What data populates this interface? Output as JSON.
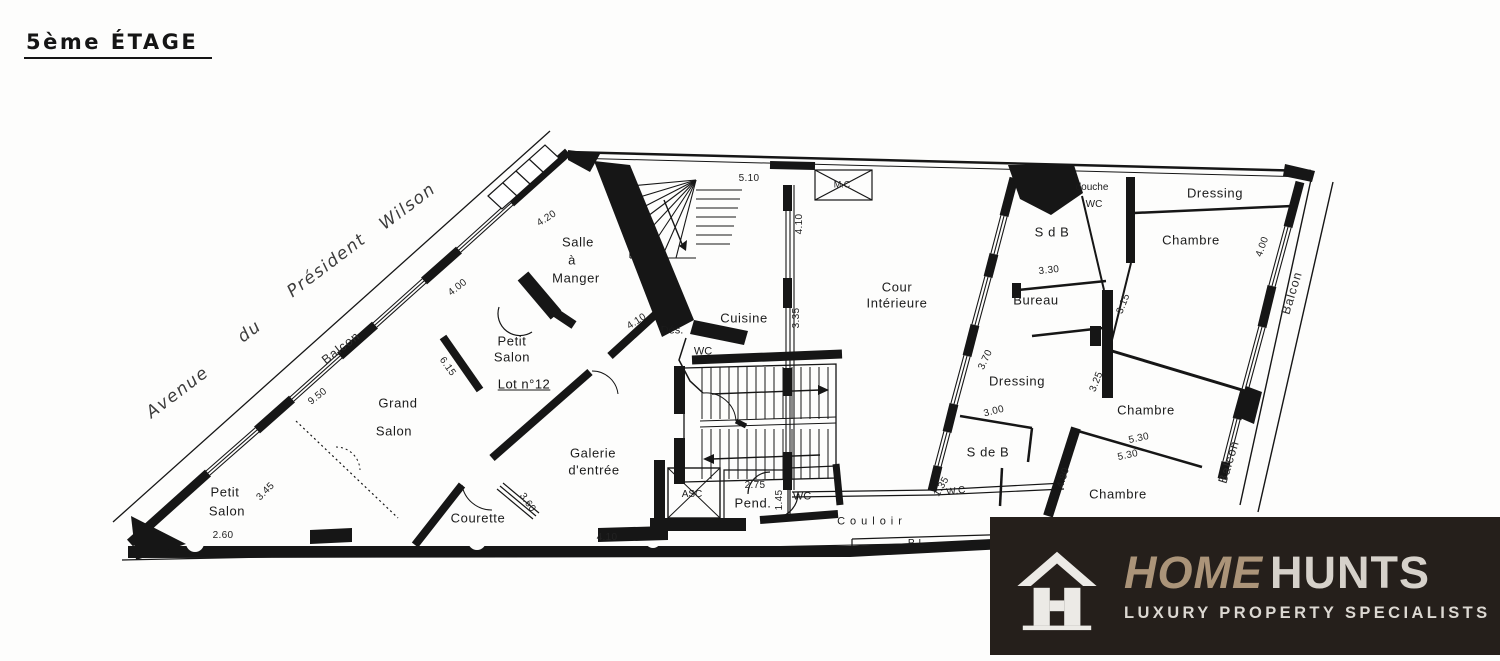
{
  "page": {
    "title": "5ème ÉTAGE"
  },
  "plan": {
    "labels": [
      {
        "text": "Avenue",
        "x": 178,
        "y": 393,
        "rot": -37,
        "cls": "street",
        "name": "street-label-avenue"
      },
      {
        "text": "du",
        "x": 250,
        "y": 332,
        "rot": -37,
        "cls": "street",
        "name": "street-label-du"
      },
      {
        "text": "Président",
        "x": 327,
        "y": 266,
        "rot": -37,
        "cls": "street",
        "name": "street-label-president"
      },
      {
        "text": "Wilson",
        "x": 408,
        "y": 207,
        "rot": -37,
        "cls": "street",
        "name": "street-label-wilson"
      },
      {
        "text": "Balcon",
        "x": 341,
        "y": 348,
        "rot": -38,
        "cls": "balcony",
        "name": "balcony-label-facade"
      },
      {
        "text": "Balcon",
        "x": 1292,
        "y": 293,
        "rot": -73,
        "cls": "balcony",
        "name": "balcony-label-right-upper"
      },
      {
        "text": "Balcon",
        "x": 1229,
        "y": 462,
        "rot": -73,
        "cls": "balcony",
        "name": "balcony-label-right-lower"
      },
      {
        "text": "Salle",
        "x": 578,
        "y": 242,
        "cls": "room",
        "name": "room-label-salle-a-manger"
      },
      {
        "text": "à",
        "x": 572,
        "y": 260,
        "cls": "room",
        "name": "room-label-salle-a-manger"
      },
      {
        "text": "Manger",
        "x": 576,
        "y": 278,
        "cls": "room",
        "name": "room-label-salle-a-manger"
      },
      {
        "text": "Petit",
        "x": 512,
        "y": 341,
        "cls": "room",
        "name": "room-label-petit-salon-1"
      },
      {
        "text": "Salon",
        "x": 512,
        "y": 357,
        "cls": "room",
        "name": "room-label-petit-salon-1"
      },
      {
        "text": "Lot n°12",
        "x": 524,
        "y": 384,
        "cls": "lot",
        "name": "area-label-lot-12"
      },
      {
        "text": "Grand",
        "x": 398,
        "y": 403,
        "cls": "room",
        "name": "room-label-grand-salon"
      },
      {
        "text": "Salon",
        "x": 394,
        "y": 431,
        "cls": "room",
        "name": "room-label-grand-salon"
      },
      {
        "text": "Petit",
        "x": 225,
        "y": 492,
        "cls": "room",
        "name": "room-label-petit-salon-2"
      },
      {
        "text": "Salon",
        "x": 227,
        "y": 511,
        "cls": "room",
        "name": "room-label-petit-salon-2"
      },
      {
        "text": "Galerie",
        "x": 593,
        "y": 453,
        "cls": "room",
        "name": "room-label-galerie"
      },
      {
        "text": "d'entrée",
        "x": 594,
        "y": 470,
        "cls": "room",
        "name": "room-label-galerie"
      },
      {
        "text": "Courette",
        "x": 478,
        "y": 518,
        "cls": "room",
        "name": "room-label-courette"
      },
      {
        "text": "Cuisine",
        "x": 744,
        "y": 318,
        "cls": "room",
        "name": "room-label-cuisine"
      },
      {
        "text": "Cour",
        "x": 897,
        "y": 287,
        "cls": "room",
        "name": "room-label-cour-interieure"
      },
      {
        "text": "Intérieure",
        "x": 897,
        "y": 303,
        "cls": "room",
        "name": "room-label-cour-interieure"
      },
      {
        "text": "S d B",
        "x": 1052,
        "y": 232,
        "cls": "room",
        "name": "room-label-sdb"
      },
      {
        "text": "Bureau",
        "x": 1036,
        "y": 300,
        "cls": "room",
        "name": "room-label-bureau"
      },
      {
        "text": "Dressing",
        "x": 1017,
        "y": 381,
        "cls": "room",
        "name": "room-label-dressing-mid"
      },
      {
        "text": "Dressing",
        "x": 1215,
        "y": 193,
        "cls": "room",
        "name": "room-label-dressing-top"
      },
      {
        "text": "Chambre",
        "x": 1191,
        "y": 240,
        "cls": "room",
        "name": "room-label-chambre-1"
      },
      {
        "text": "Chambre",
        "x": 1146,
        "y": 410,
        "cls": "room",
        "name": "room-label-chambre-2"
      },
      {
        "text": "Chambre",
        "x": 1118,
        "y": 494,
        "cls": "room",
        "name": "room-label-chambre-3"
      },
      {
        "text": "S de B",
        "x": 988,
        "y": 452,
        "cls": "room",
        "name": "room-label-s-de-b"
      },
      {
        "text": "Pend.",
        "x": 753,
        "y": 503,
        "cls": "room",
        "name": "room-label-penderie"
      },
      {
        "text": "Couloir",
        "x": 872,
        "y": 522,
        "ls": 5,
        "cls": "small",
        "name": "room-label-couloir"
      },
      {
        "text": "PL",
        "x": 918,
        "y": 544,
        "ls": 4,
        "size": 10,
        "cls": "small",
        "name": "room-label-placard"
      },
      {
        "text": "WC",
        "x": 703,
        "y": 352,
        "cls": "small",
        "name": "room-label-wc-cuisine"
      },
      {
        "text": "Dés.",
        "x": 672,
        "y": 331,
        "cls": "small",
        "name": "room-label-degagement"
      },
      {
        "text": "M.C",
        "x": 842,
        "y": 185,
        "size": 9,
        "cls": "small",
        "name": "room-label-monte-charge"
      },
      {
        "text": "douche",
        "x": 1092,
        "y": 188,
        "size": 10,
        "cls": "small",
        "name": "room-label-douche"
      },
      {
        "text": "WC",
        "x": 1094,
        "y": 205,
        "size": 10,
        "cls": "small",
        "name": "room-label-wc-douche"
      },
      {
        "text": "W.C",
        "x": 956,
        "y": 492,
        "rot": -8,
        "size": 10,
        "cls": "small",
        "name": "room-label-wc-couloir"
      },
      {
        "text": "ASC",
        "x": 692,
        "y": 495,
        "size": 10,
        "cls": "small",
        "name": "room-label-ascenseur"
      },
      {
        "text": "WC",
        "x": 802,
        "y": 497,
        "cls": "small",
        "name": "room-label-wc-hall"
      },
      {
        "text": "4.20",
        "x": 547,
        "y": 219,
        "rot": -33,
        "cls": "dim",
        "name": "dimension-label"
      },
      {
        "text": "5.10",
        "x": 749,
        "y": 179,
        "cls": "dim",
        "name": "dimension-label"
      },
      {
        "text": "4.10",
        "x": 800,
        "y": 224,
        "rot": -90,
        "cls": "dim",
        "name": "dimension-label"
      },
      {
        "text": "3.35",
        "x": 797,
        "y": 318,
        "rot": -90,
        "cls": "dim",
        "name": "dimension-label"
      },
      {
        "text": "4.10",
        "x": 637,
        "y": 322,
        "rot": -33,
        "cls": "dim",
        "name": "dimension-label"
      },
      {
        "text": "6.15",
        "x": 447,
        "y": 367,
        "rot": 55,
        "cls": "dim",
        "name": "dimension-label"
      },
      {
        "text": "9.50",
        "x": 318,
        "y": 397,
        "rot": -38,
        "cls": "dim",
        "name": "dimension-label"
      },
      {
        "text": "4.00",
        "x": 458,
        "y": 288,
        "rot": -38,
        "cls": "dim",
        "name": "dimension-label"
      },
      {
        "text": "3.45",
        "x": 266,
        "y": 492,
        "rot": -45,
        "cls": "dim",
        "name": "dimension-label"
      },
      {
        "text": "2.60",
        "x": 223,
        "y": 536,
        "cls": "dim",
        "name": "dimension-label"
      },
      {
        "text": "3.60",
        "x": 527,
        "y": 503,
        "rot": 55,
        "cls": "dim",
        "name": "dimension-label"
      },
      {
        "text": "4.10",
        "x": 607,
        "y": 538,
        "cls": "dim",
        "name": "dimension-label"
      },
      {
        "text": "2.75",
        "x": 755,
        "y": 486,
        "cls": "dim",
        "name": "dimension-label"
      },
      {
        "text": "1.45",
        "x": 780,
        "y": 500,
        "rot": -90,
        "cls": "dim",
        "name": "dimension-label"
      },
      {
        "text": "1.35",
        "x": 942,
        "y": 487,
        "rot": -60,
        "cls": "dim",
        "name": "dimension-label"
      },
      {
        "text": "3.00",
        "x": 994,
        "y": 412,
        "rot": -14,
        "cls": "dim",
        "name": "dimension-label"
      },
      {
        "text": "3.30",
        "x": 1049,
        "y": 271,
        "rot": -6,
        "cls": "dim",
        "name": "dimension-label"
      },
      {
        "text": "3.70",
        "x": 986,
        "y": 360,
        "rot": -65,
        "cls": "dim",
        "name": "dimension-label"
      },
      {
        "text": "3.15",
        "x": 1124,
        "y": 304,
        "rot": -68,
        "cls": "dim",
        "name": "dimension-label"
      },
      {
        "text": "3.25",
        "x": 1097,
        "y": 382,
        "rot": -68,
        "cls": "dim",
        "name": "dimension-label"
      },
      {
        "text": "4.00",
        "x": 1263,
        "y": 247,
        "rot": -70,
        "cls": "dim",
        "name": "dimension-label"
      },
      {
        "text": "5.30",
        "x": 1139,
        "y": 439,
        "rot": -12,
        "cls": "dim",
        "name": "dimension-label"
      },
      {
        "text": "5.30",
        "x": 1128,
        "y": 456,
        "rot": -12,
        "cls": "dim",
        "name": "dimension-label"
      },
      {
        "text": "4.80",
        "x": 1064,
        "y": 478,
        "rot": -72,
        "cls": "dim",
        "name": "dimension-label"
      }
    ]
  },
  "logo": {
    "brand_primary": "HOME",
    "brand_secondary": "HUNTS",
    "tagline": "LUXURY PROPERTY SPECIALISTS",
    "background": "#251f1b",
    "brand_primary_color": "#ab9479",
    "brand_secondary_color": "#d6d1ca",
    "tagline_color": "#dcd8d2",
    "icon_color": "#eceae6"
  }
}
